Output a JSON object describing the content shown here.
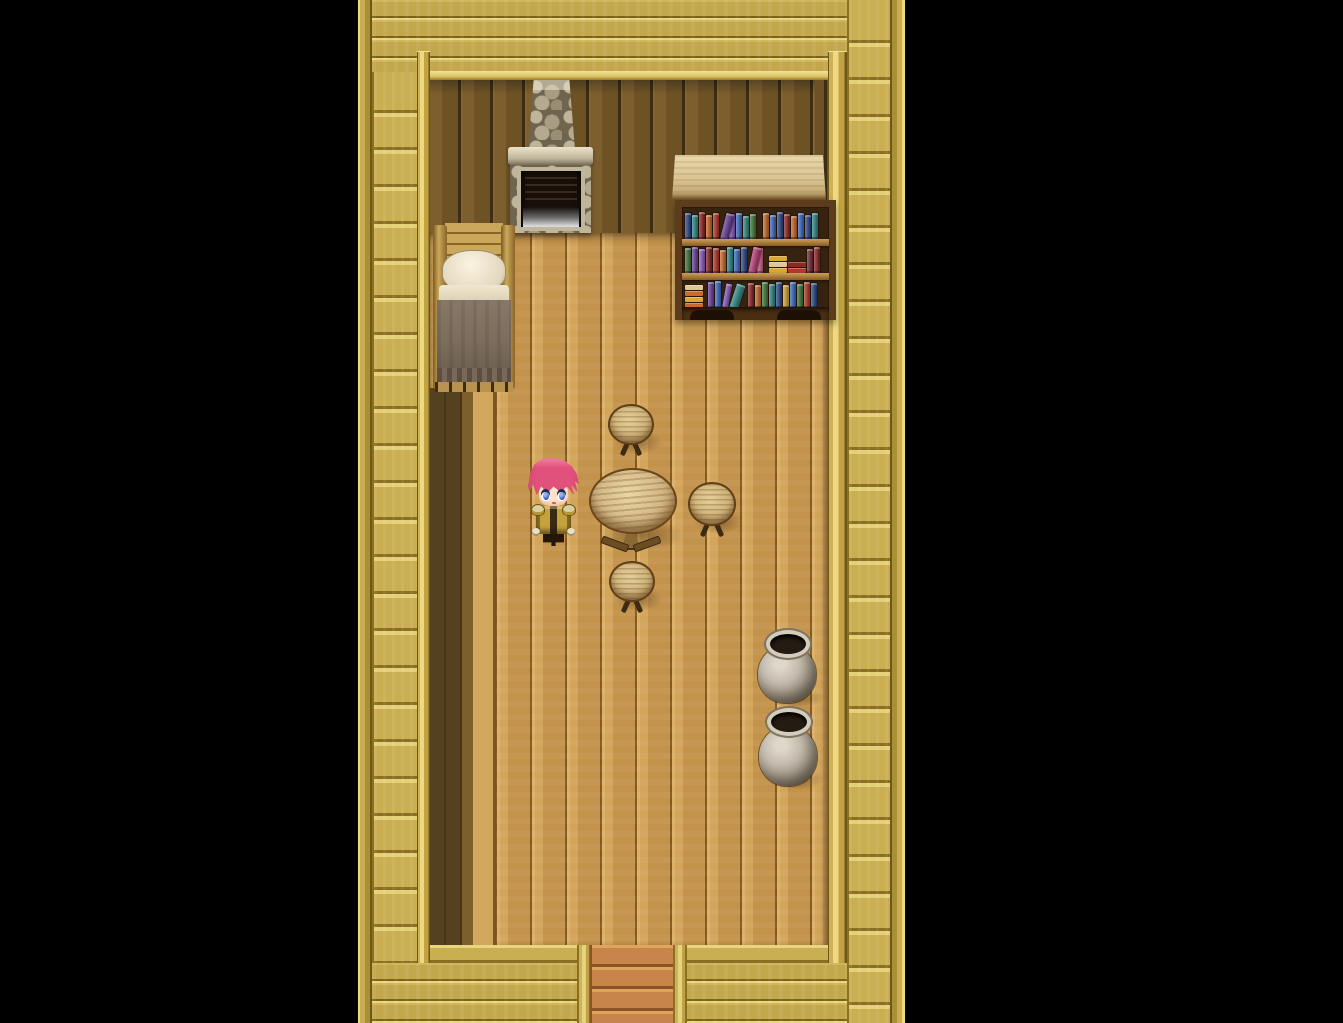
{
  "scene": {
    "type": "rpg-interior-map",
    "viewport": {
      "width": 1343,
      "height": 1023
    },
    "game_area": {
      "x": 357,
      "y": 0,
      "width": 549,
      "height": 1023
    },
    "visible_text": []
  },
  "palette": {
    "void": "#000000",
    "frame_gold": "#c2a74d",
    "frame_highlight": "#ecd981",
    "frame_seam": "#7c6219",
    "wall_dark": "#6e5226",
    "floor": "#c3934c",
    "floor_shadow": "#55401f",
    "mat_orange": "#c8854a",
    "stone": "#a89d83",
    "pot_grey": "#c4bcae",
    "blanket": "#7b6c5c",
    "hair_pink": "#e0517b",
    "eye_blue": "#3f64c8",
    "outfit_gold": "#c4a23c",
    "books": {
      "navy": "#2d4a8e",
      "blue": "#3a6bc6",
      "teal": "#2f8a86",
      "green": "#41793b",
      "red": "#b5372b",
      "crimson": "#8e2722",
      "orange": "#c96a2a",
      "yellow": "#d8a832",
      "purple": "#6b3f9e",
      "violet": "#8a5bc4",
      "magenta": "#bf3d7c",
      "pink": "#d4678f",
      "maroon": "#762a36",
      "cream": "#ddc993"
    }
  },
  "entities": {
    "room_wall": {
      "x": 73,
      "y": 80,
      "w": 398,
      "h": 153
    },
    "wall_alcove": {
      "x": 458,
      "y": 80,
      "w": 13,
      "h": 230
    },
    "room_floor": {
      "x": 73,
      "y": 233,
      "w": 398,
      "h": 712
    },
    "shadow_col_dark": {
      "x": 73,
      "y": 388,
      "w": 32,
      "h": 557
    },
    "shadow_col_med": {
      "x": 105,
      "y": 388,
      "w": 11,
      "h": 557
    },
    "shadow_col_light": {
      "x": 116,
      "y": 388,
      "w": 23,
      "h": 557
    },
    "fireplace": {
      "x": 151,
      "y": 80,
      "w": 85,
      "h": 153
    },
    "bed": {
      "x": 76,
      "y": 221,
      "w": 82,
      "h": 171
    },
    "bookshelf_canopy": {
      "x": 315,
      "y": 155,
      "w": 154,
      "h": 45
    },
    "bookshelf": {
      "x": 318,
      "y": 200,
      "w": 147,
      "h": 113
    },
    "stool_top": {
      "x": 251,
      "y": 404,
      "w": 46,
      "h": 52
    },
    "stool_right": {
      "x": 331,
      "y": 482,
      "w": 48,
      "h": 55
    },
    "stool_bottom": {
      "x": 252,
      "y": 561,
      "w": 46,
      "h": 52
    },
    "table": {
      "x": 232,
      "y": 468,
      "w": 84,
      "h": 86
    },
    "player": {
      "x": 170,
      "y": 456,
      "w": 53,
      "h": 92
    },
    "pot_1": {
      "x": 399,
      "y": 630,
      "w": 64,
      "h": 77
    },
    "pot_2": {
      "x": 400,
      "y": 708,
      "w": 64,
      "h": 81
    },
    "door_post_left": {
      "x": 220,
      "y": 945,
      "w": 14,
      "h": 78
    },
    "door_post_right": {
      "x": 316,
      "y": 945,
      "w": 14,
      "h": 78
    }
  },
  "bookshelf": {
    "shelves": [
      {
        "items": [
          {
            "c": "navy",
            "h": 26
          },
          {
            "c": "teal",
            "h": 24
          },
          {
            "c": "crimson",
            "h": 27
          },
          {
            "c": "orange",
            "h": 24
          },
          {
            "c": "red",
            "h": 26
          },
          {
            "c": "purple",
            "h": 27,
            "lean": 14,
            "w": 8
          },
          {
            "c": "violet",
            "h": 25
          },
          {
            "c": "blue",
            "h": 26
          },
          {
            "c": "teal",
            "h": 23
          },
          {
            "c": "green",
            "h": 25
          },
          {
            "gap": 5
          },
          {
            "c": "orange",
            "h": 26
          },
          {
            "c": "blue",
            "h": 24
          },
          {
            "c": "navy",
            "h": 27
          },
          {
            "c": "crimson",
            "h": 25
          },
          {
            "c": "orange",
            "h": 23
          },
          {
            "c": "blue",
            "h": 26
          },
          {
            "c": "navy",
            "h": 24
          },
          {
            "c": "teal",
            "h": 26
          }
        ]
      },
      {
        "items": [
          {
            "c": "green",
            "h": 25
          },
          {
            "c": "purple",
            "h": 26
          },
          {
            "c": "violet",
            "h": 24
          },
          {
            "c": "crimson",
            "h": 26
          },
          {
            "c": "red",
            "h": 25
          },
          {
            "c": "orange",
            "h": 23
          },
          {
            "c": "teal",
            "h": 26
          },
          {
            "c": "blue",
            "h": 24
          },
          {
            "c": "navy",
            "h": 26
          },
          {
            "c": "magenta",
            "h": 27,
            "lean": 12,
            "w": 8
          },
          {
            "c": "pink",
            "h": 25
          },
          {
            "gap": 4
          },
          {
            "stack": [
              "yellow",
              "cream",
              "yellow"
            ]
          },
          {
            "stack": [
              "red",
              "crimson"
            ]
          },
          {
            "c": "maroon",
            "h": 24
          },
          {
            "c": "crimson",
            "h": 26
          }
        ]
      },
      {
        "items": [
          {
            "stack": [
              "orange",
              "yellow",
              "orange",
              "cream"
            ]
          },
          {
            "gap": 3
          },
          {
            "c": "purple",
            "h": 26
          },
          {
            "c": "blue",
            "h": 27
          },
          {
            "c": "violet",
            "h": 25,
            "lean": 10
          },
          {
            "c": "teal",
            "h": 26,
            "lean": 18,
            "w": 9
          },
          {
            "gap": 8
          },
          {
            "c": "crimson",
            "h": 25
          },
          {
            "c": "orange",
            "h": 23
          },
          {
            "c": "green",
            "h": 26
          },
          {
            "c": "teal",
            "h": 24
          },
          {
            "c": "navy",
            "h": 26
          },
          {
            "c": "yellow",
            "h": 23
          },
          {
            "c": "blue",
            "h": 26
          },
          {
            "c": "green",
            "h": 24
          },
          {
            "c": "red",
            "h": 26
          },
          {
            "c": "navy",
            "h": 25
          }
        ]
      }
    ]
  }
}
